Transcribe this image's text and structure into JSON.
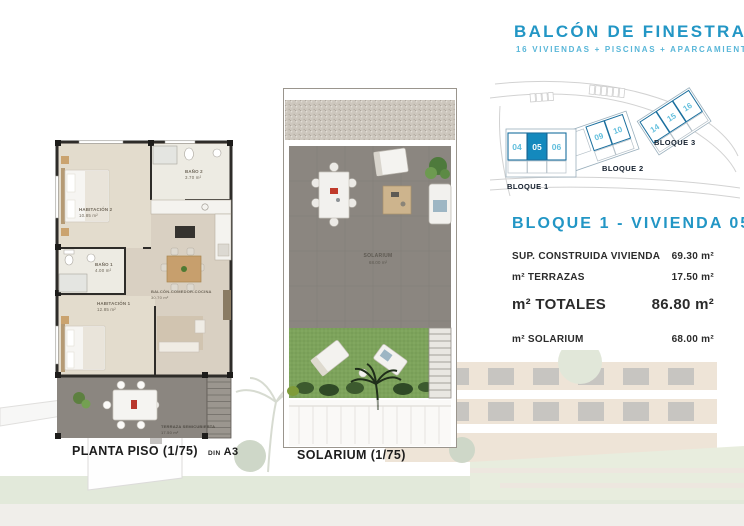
{
  "header": {
    "title": "BALCÓN DE FINESTRAT",
    "subtitle": "16 VIVIENDAS + PISCINAS + APARCAMIENTO"
  },
  "site_plan": {
    "bloque1": {
      "label": "BLOQUE 1",
      "units": [
        "04",
        "05",
        "06"
      ],
      "highlighted_unit": "05"
    },
    "bloque2": {
      "label": "BLOQUE 2",
      "units": [
        "09",
        "10"
      ]
    },
    "bloque3": {
      "label": "BLOQUE 3",
      "units": [
        "14",
        "15",
        "16"
      ]
    }
  },
  "details": {
    "heading": "BLOQUE 1 - VIVIENDA 05",
    "construida": {
      "label": "SUP. CONSTRUIDA VIVIENDA",
      "value": "69.30 m²"
    },
    "terrazas": {
      "label": "m² TERRAZAS",
      "value": "17.50 m²"
    },
    "totales": {
      "label": "m² TOTALES",
      "value": "86.80 m²"
    },
    "solarium": {
      "label": "m² SOLARIUM",
      "value": "68.00 m²"
    }
  },
  "floor_plan": {
    "caption": "PLANTA PISO (1/75)",
    "din": "DIN",
    "sheet": "A3",
    "rooms": {
      "habitacion2": {
        "name": "HABITACIÓN 2",
        "area": "10.85 m²"
      },
      "bano2": {
        "name": "BAÑO 2",
        "area": "3.70 m²"
      },
      "bano1": {
        "name": "BAÑO 1",
        "area": "4.00 m²"
      },
      "habitacion1": {
        "name": "HABITACIÓN 1",
        "area": "12.85 m²"
      },
      "balcon_comedor": {
        "name": "BALCÓN-COMEDOR-COCINA",
        "area": "30.70 m²"
      },
      "terraza": {
        "name": "TERRAZA SEMICUBIERTA",
        "area": "17.50 m²"
      }
    }
  },
  "solarium": {
    "caption": "SOLARIUM (1/75)",
    "label": "SOLARIUM",
    "area": "68.00 m²"
  },
  "colors": {
    "brand_blue": "#2296c5",
    "subtitle_blue": "#58b6d8",
    "unit_number_blue": "#62bfdd",
    "highlight_blue": "#1489bd",
    "dark_text": "#2b2b2b",
    "plan_beige": "#d9d0c2",
    "terrace_gray": "#8b8680",
    "grass_green": "#7da35b"
  }
}
